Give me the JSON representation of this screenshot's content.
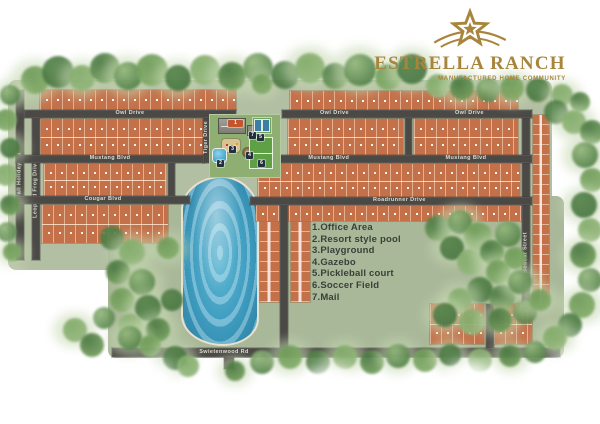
{
  "brand": {
    "title": "ESTRELLA RANCH",
    "subtitle": "MANUFACTURED HOME COMMUNITY",
    "gold": "#a8853c",
    "icon": "star-swoosh"
  },
  "legend": {
    "items": [
      "1.Office Area",
      "2.Resort style pool",
      "3.Playground",
      "4.Gazebo",
      "5.Pickleball court",
      "6.Soccer Field",
      "7.Mail"
    ]
  },
  "streets": {
    "owl": "Owl Drive",
    "mustang": "Mustang Blvd",
    "cougar": "Cougar Blvd",
    "roadrunner": "Roadrunner Drive",
    "swietenia": "Swietenwood Rd",
    "fall_holiday": "Fall Holiday Rd",
    "leopard_frog": "Leopard Frog Drive",
    "tiger": "Tiger Drive",
    "bobcat": "Bobcat Street"
  },
  "markers": {
    "m1": "1",
    "m2": "2",
    "m3": "3",
    "m4": "4",
    "m5": "5",
    "m6": "6",
    "m7": "7"
  },
  "colors": {
    "lot": "#c4714a",
    "road": "#4b4945",
    "water": "#3f9cbf",
    "grass": "#b3bfa3",
    "gold": "#a8853c"
  }
}
